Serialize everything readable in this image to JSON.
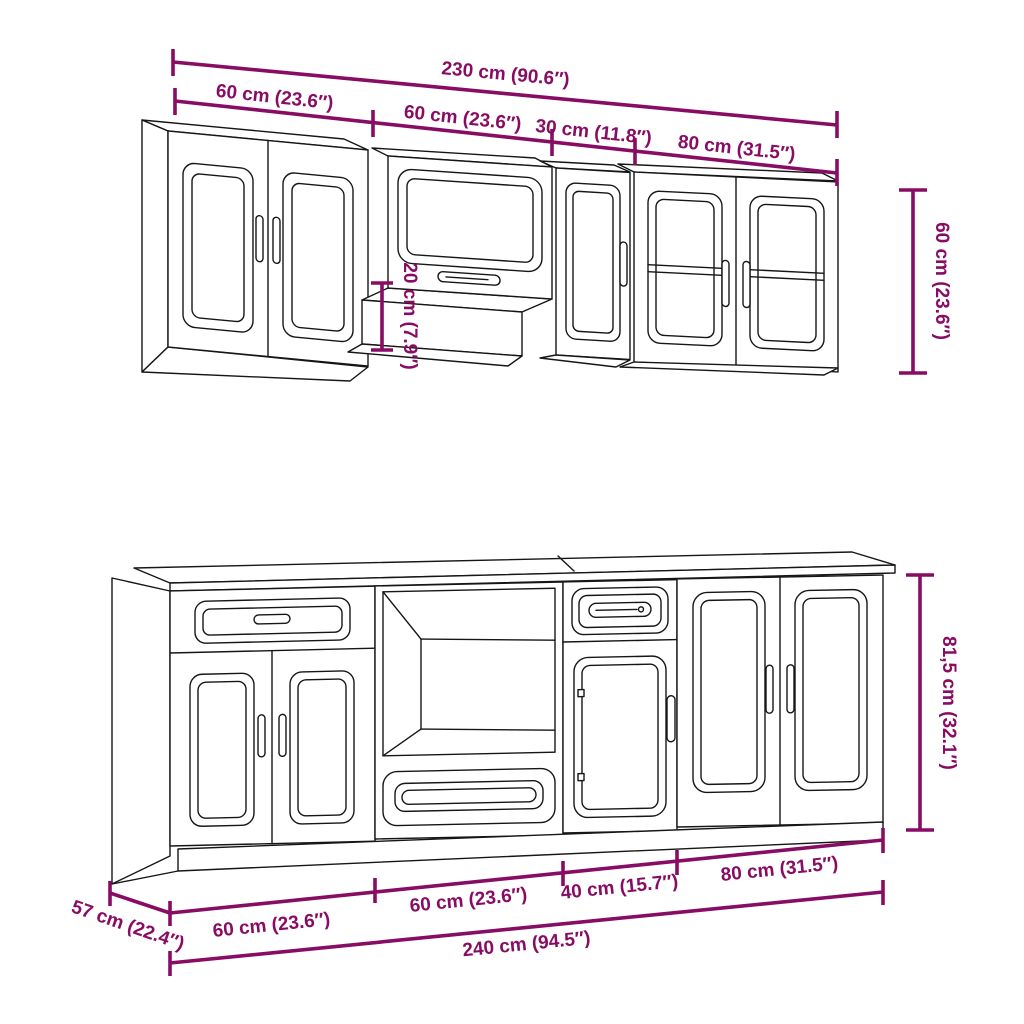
{
  "colors": {
    "dimension_accent": "#880c64",
    "line_art": "#161616",
    "background": "#ffffff"
  },
  "wall": {
    "total_width": "230 cm (90.6″)",
    "segment_1": "60 cm (23.6″)",
    "segment_2": "60 cm (23.6″)",
    "segment_3": "30 cm (11.8″)",
    "segment_4": "80 cm (31.5″)",
    "height": "60 cm (23.6″)",
    "drop_height": "20 cm (7.9″)"
  },
  "base": {
    "depth": "57 cm (22.4″)",
    "segment_1": "60 cm (23.6″)",
    "segment_2": "60 cm (23.6″)",
    "segment_3": "40 cm (15.7″)",
    "segment_4": "80 cm (31.5″)",
    "total_width": "240 cm (94.5″)",
    "height": "81,5 cm (32.1″)"
  }
}
